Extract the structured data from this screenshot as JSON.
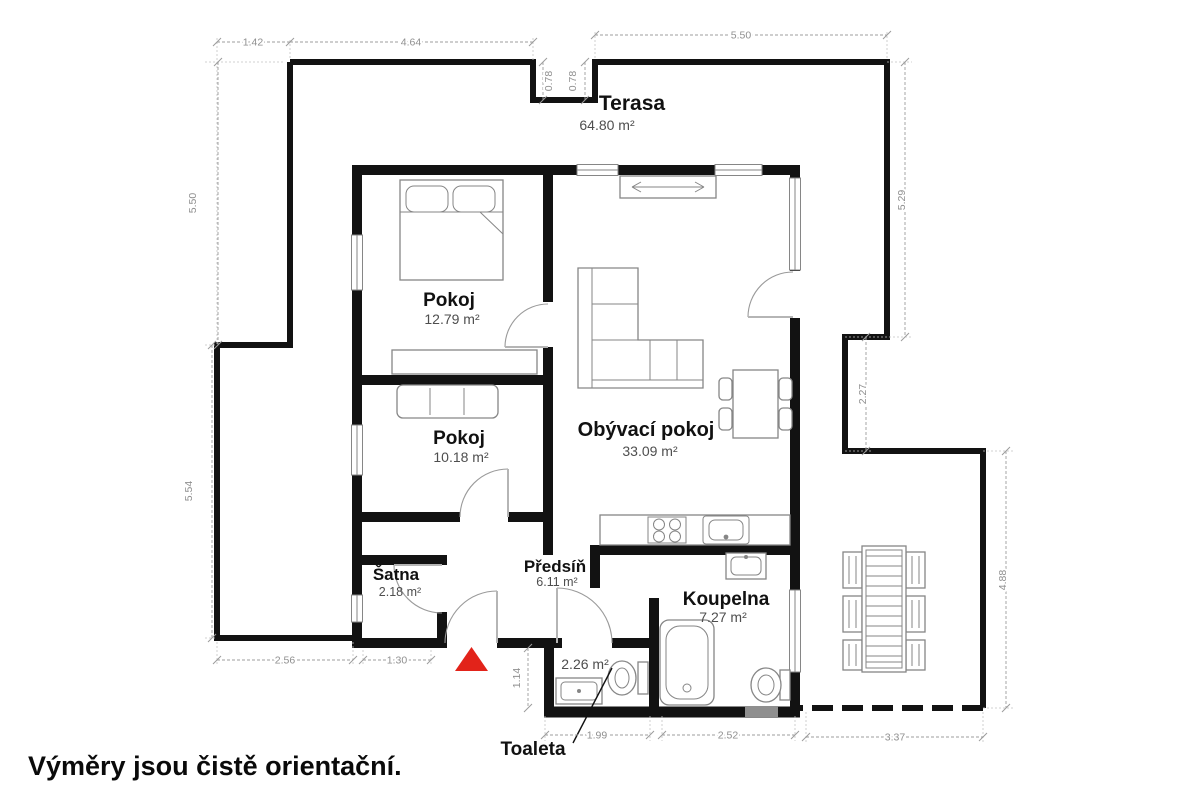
{
  "plan": {
    "disclaimer": "Výměry jsou čistě orientační.",
    "rooms": {
      "terasa": {
        "name": "Terasa",
        "area": "64.80 m²"
      },
      "pokoj1": {
        "name": "Pokoj",
        "area": "12.79 m²"
      },
      "obyvaci_pokoj": {
        "name": "Obývací pokoj",
        "area": "33.09 m²"
      },
      "pokoj2": {
        "name": "Pokoj",
        "area": "10.18 m²"
      },
      "satna": {
        "name": "Šatna",
        "area": "2.18 m²"
      },
      "predsin": {
        "name": "Předsíň",
        "area": "6.11 m²"
      },
      "koupelna": {
        "name": "Koupelna",
        "area": "7.27 m²"
      },
      "toaleta": {
        "name": "Toaleta",
        "area": "2.26 m²"
      }
    },
    "dimensions": {
      "top_left_offset": "1.42",
      "top_left": "4.64",
      "top_right": "5.50",
      "notch_left": "0.78",
      "notch_right": "0.78",
      "left_upper": "5.50",
      "left_lower": "5.54",
      "right_upper": "5.29",
      "right_middle": "2.27",
      "right_lower": "4.88",
      "bottom_terrace_left": "2.56",
      "bottom_satna": "1.30",
      "toilet_depth": "1.14",
      "bottom_toaleta": "1.99",
      "bottom_koupelna": "2.52",
      "bottom_terrace_right": "3.37"
    },
    "colors": {
      "wall": "#121212",
      "furn": "#868686",
      "dim": "#9c9c9c",
      "dimtext": "#8f8f8f",
      "area": "#4e4e4e",
      "room": "#111111",
      "entrance": "#e2231a",
      "lowwin": "#8f8f8f"
    }
  }
}
